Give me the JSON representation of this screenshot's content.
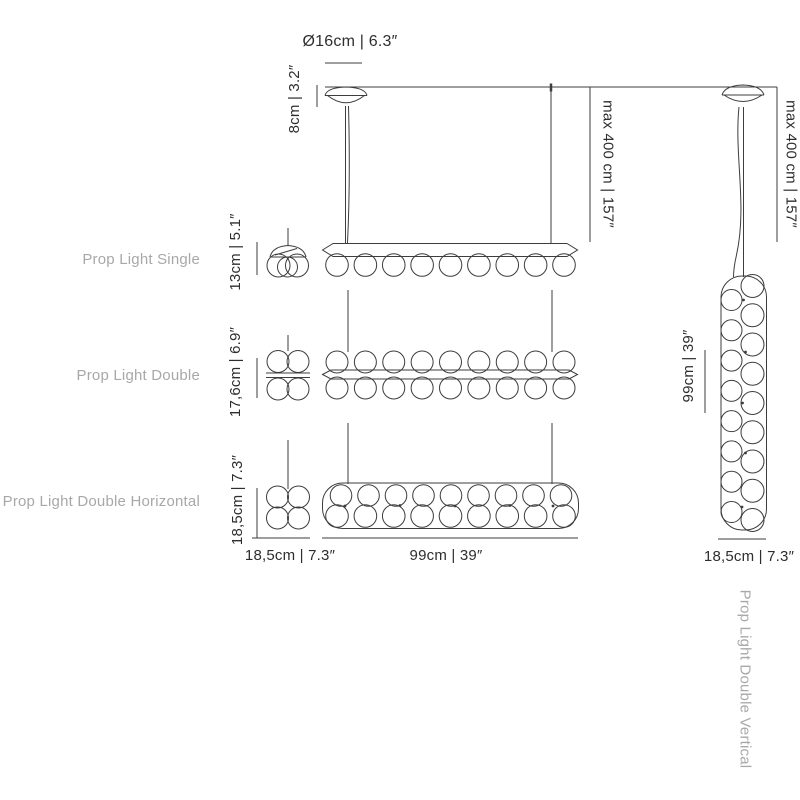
{
  "colors": {
    "background": "#ffffff",
    "line": "#3d3d3d",
    "product_label": "#a8a8a8",
    "dimension_text": "#2e2e2e"
  },
  "mounting": {
    "canopy_diameter": "Ø16cm | 6.3″",
    "canopy_height": "8cm | 3.2″",
    "max_drop": "max 400 cm | 157″",
    "max_drop_right": "max 400 cm | 157″"
  },
  "products": {
    "single": {
      "name": "Prop Light Single",
      "height": "13cm | 5.1″"
    },
    "double": {
      "name": "Prop Light Double",
      "height": "17,6cm | 6.9″"
    },
    "double_horizontal": {
      "name": "Prop Light Double Horizontal",
      "height": "18,5cm | 7.3″",
      "depth": "18,5cm | 7.3″",
      "length": "99cm | 39″"
    },
    "double_vertical": {
      "name": "Prop Light Double Vertical",
      "length": "99cm | 39″",
      "width": "18,5cm | 7.3″"
    }
  }
}
